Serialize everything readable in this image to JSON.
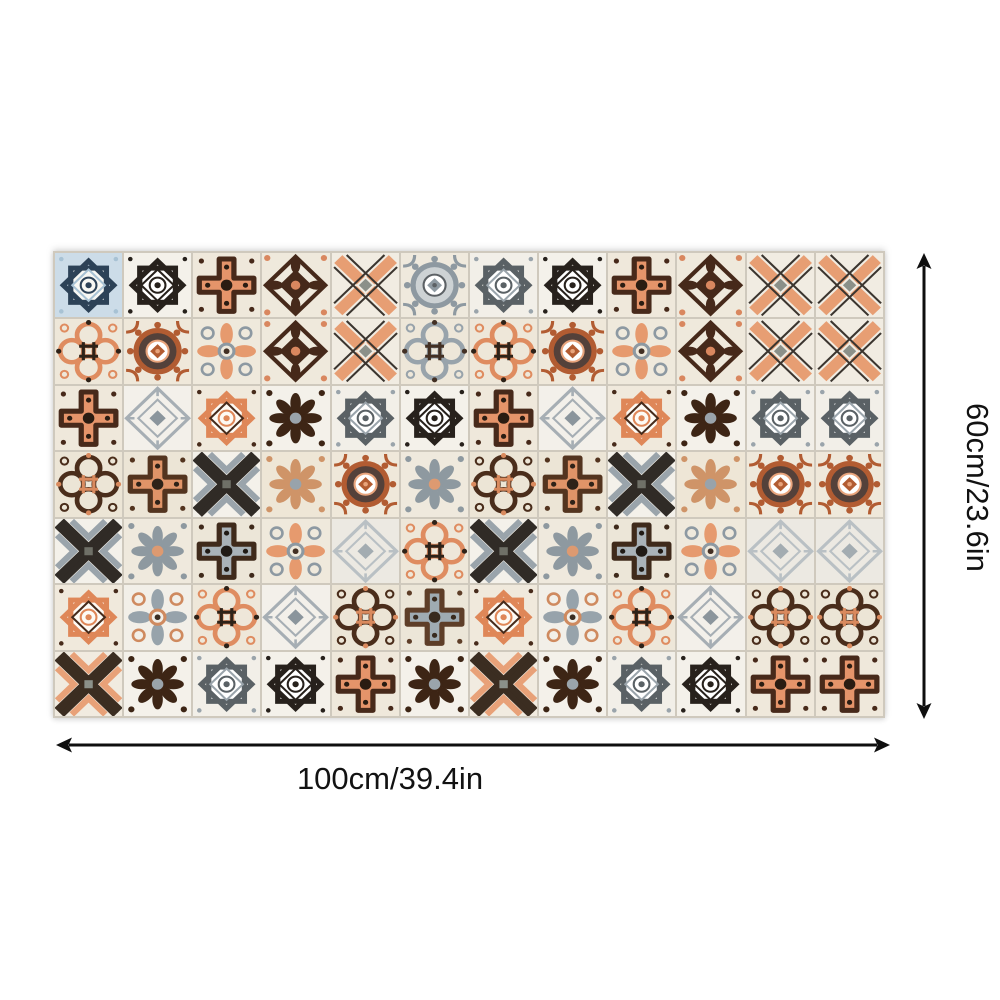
{
  "product_image": {
    "description": "Patchwork sheet of Moroccan-style mosaic tile decals shown flat on white background with size callouts",
    "background_color": "#ffffff"
  },
  "dimensions": {
    "height_label": "60cm/23.6in",
    "width_label": "100cm/39.4in",
    "arrow_color": "#0f0f0f"
  },
  "tile_mat": {
    "rows": 7,
    "cols": 12,
    "grout_color": "#cfc9bd",
    "palette": {
      "cream": "#efe8db",
      "orange": "#e5946a",
      "dark_brown": "#47291a",
      "near_black": "#27211c",
      "slate_gray": "#9aa4ab",
      "navy_blue": "#2d4257",
      "light_blue": "#ccdce8"
    },
    "motifs": {
      "starBlue": {
        "type": "star8",
        "bg": "#ccdce8",
        "inner": "#f7f7f3",
        "outer": "#2d4257",
        "accent": "#a8c2d4"
      },
      "starBlack": {
        "type": "star8",
        "bg": "#f4f1ea",
        "inner": "#ffffff",
        "outer": "#27211c",
        "accent": "#27211c"
      },
      "starGray": {
        "type": "star8",
        "bg": "#f2efe8",
        "inner": "#ffffff",
        "outer": "#5a6165",
        "accent": "#9aa4ab"
      },
      "starOrange": {
        "type": "star8",
        "bg": "#f0e9dc",
        "inner": "#fdfaf4",
        "outer": "#df8758",
        "accent": "#472b1b"
      },
      "crossOrange": {
        "type": "cross",
        "bg": "#efe8db",
        "fill": "#e5946a",
        "outline": "#47291a",
        "center": "#2a1c12"
      },
      "crossBrownGray": {
        "type": "cross",
        "bg": "#ece6d8",
        "fill": "#a9b2b8",
        "outline": "#3f2a1b",
        "center": "#201a15"
      },
      "crossGrayFrame": {
        "type": "cross",
        "bg": "#ece6d8",
        "fill": "#9fabb2",
        "outline": "#5e3e28",
        "center": "#382a1e"
      },
      "crossHash": {
        "type": "cross",
        "bg": "#ece5d6",
        "fill": "#e09468",
        "outline": "#53341f",
        "center": "#2e2218"
      },
      "floralBrown": {
        "type": "diamondFloral",
        "bg": "#efe9dc",
        "main": "#46291a",
        "accent": "#d9875f"
      },
      "floralDense": {
        "type": "floral",
        "bg": "#f4f1ea",
        "main": "#3d2515",
        "accent": "#9aa4ab"
      },
      "floralCream": {
        "type": "floral",
        "bg": "#eee6d6",
        "main": "#cf9468",
        "accent": "#98a3ab"
      },
      "floralSmall": {
        "type": "floral",
        "bg": "#efe9dd",
        "main": "#8e99a0",
        "accent": "#dd9a71"
      },
      "xLattice": {
        "type": "xlattice",
        "bg": "#f1ece2",
        "bar": "#e79e73",
        "stripe": "#3b352f",
        "center": "#8b9089"
      },
      "xChevron": {
        "type": "xchevron",
        "bg": "#f4f1ea",
        "dark": "#302b26",
        "light": "#9aa4ab",
        "center": "#6f7067"
      },
      "xOrange": {
        "type": "xchevron",
        "bg": "#f1ebe0",
        "dark": "#3b2d21",
        "light": "#e8a178",
        "center": "#8b9089"
      },
      "medGray": {
        "type": "medallion",
        "bg": "#efe9dd",
        "ring": "#8e99a1",
        "core": "#cdd2d4",
        "accent": "#5c6165"
      },
      "medOB": {
        "type": "medallion",
        "bg": "#efe8da",
        "ring": "#b25c32",
        "core": "#54413a",
        "accent": "#e8a47c"
      },
      "quatOrange": {
        "type": "quatrefoil",
        "bg": "#eee7d9",
        "main": "#df8c60",
        "center": "#2e2218"
      },
      "quatGray": {
        "type": "quatrefoil",
        "bg": "#eee7d9",
        "main": "#98a3ab",
        "center": "#433024"
      },
      "quatDark": {
        "type": "quatrefoil",
        "bg": "#ece5d6",
        "main": "#4a2d1b",
        "center": "#d98a5e"
      },
      "petalRings": {
        "type": "petals",
        "bg": "#efe9dc",
        "petal": "#e69a6e",
        "ring": "#8d99a2",
        "accent": "#433024"
      },
      "petalLeaf": {
        "type": "petals",
        "bg": "#f2efe8",
        "petal": "#97a3ab",
        "ring": "#cf8a5f",
        "accent": "#3a2d22"
      },
      "diamondGray": {
        "type": "diamond",
        "bg": "#f3f0ea",
        "main": "#a6aeb4",
        "accent": "#8b959c"
      },
      "diamondLight": {
        "type": "diamond",
        "bg": "#ece9e2",
        "main": "#b9c0c4",
        "accent": "#a3acb1"
      }
    },
    "grid": [
      [
        "starBlue",
        "starBlack",
        "crossOrange",
        "floralBrown",
        "xLattice",
        "medGray",
        "starGray",
        "starBlack",
        "crossOrange",
        "floralBrown",
        "xLattice",
        "xLattice"
      ],
      [
        "quatOrange",
        "medOB",
        "petalRings",
        "floralBrown",
        "xLattice",
        "quatGray",
        "quatOrange",
        "medOB",
        "petalRings",
        "floralBrown",
        "xLattice",
        "xLattice"
      ],
      [
        "crossOrange",
        "diamondGray",
        "starOrange",
        "floralDense",
        "starGray",
        "starBlack",
        "crossOrange",
        "diamondGray",
        "starOrange",
        "floralDense",
        "starGray",
        "starGray"
      ],
      [
        "quatDark",
        "crossHash",
        "xChevron",
        "floralCream",
        "medOB",
        "floralSmall",
        "quatDark",
        "crossHash",
        "xChevron",
        "floralCream",
        "medOB",
        "medOB"
      ],
      [
        "xChevron",
        "floralSmall",
        "crossBrownGray",
        "petalRings",
        "diamondLight",
        "quatOrange",
        "xChevron",
        "floralSmall",
        "crossBrownGray",
        "petalRings",
        "diamondLight",
        "diamondLight"
      ],
      [
        "starOrange",
        "petalLeaf",
        "quatOrange",
        "diamondGray",
        "quatDark",
        "crossGrayFrame",
        "starOrange",
        "petalLeaf",
        "quatOrange",
        "diamondGray",
        "quatDark",
        "quatDark"
      ],
      [
        "xOrange",
        "floralDense",
        "starGray",
        "starBlack",
        "crossOrange",
        "floralDense",
        "xOrange",
        "floralDense",
        "starGray",
        "starBlack",
        "crossOrange",
        "crossOrange"
      ]
    ]
  }
}
